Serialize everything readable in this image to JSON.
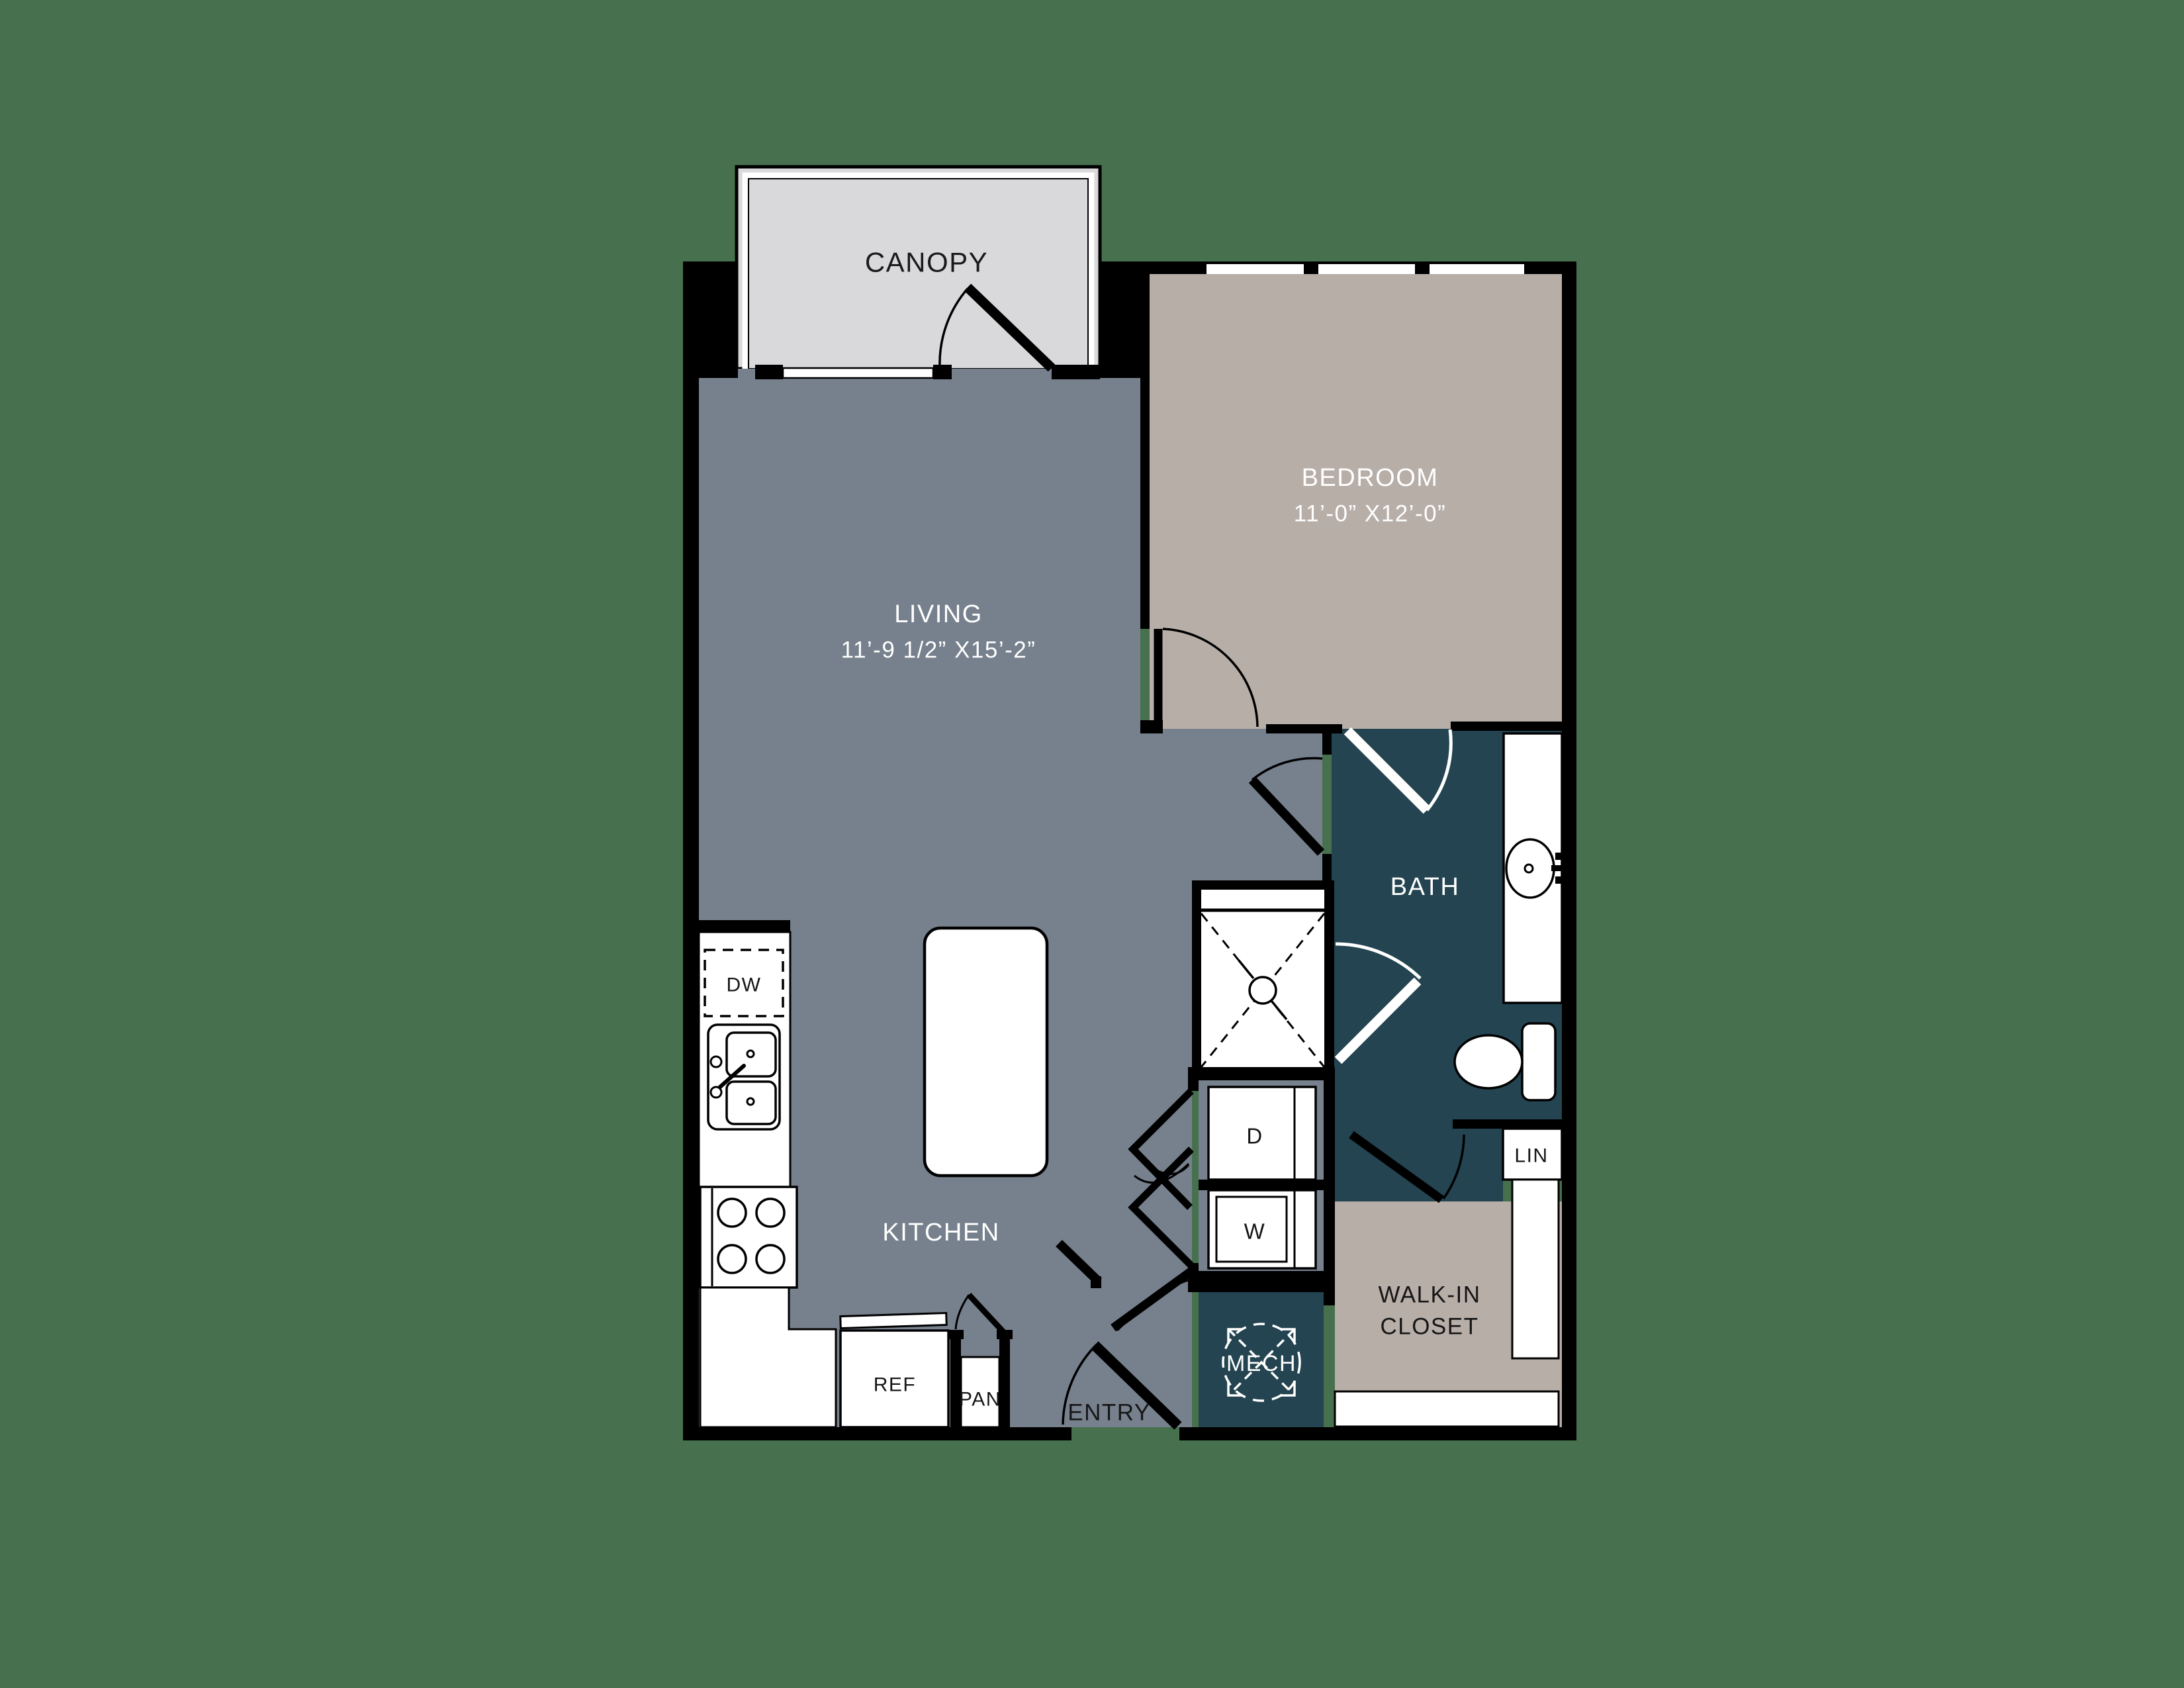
{
  "floorplan": {
    "background_color": "#47714E",
    "colors": {
      "floor_gray": "#77818D",
      "floor_tan": "#B7AEA8",
      "floor_teal": "#234450",
      "canopy_gray": "#D9D9DB",
      "wall_black": "#000000",
      "fixture_white": "#FFFFFF"
    },
    "rooms": {
      "canopy": {
        "label": "CANOPY"
      },
      "living": {
        "label": "LIVING",
        "dims": "11’-9 1/2” X15’-2”"
      },
      "bedroom": {
        "label": "BEDROOM",
        "dims": "11’-0” X12’-0”"
      },
      "bath": {
        "label": "BATH"
      },
      "kitchen": {
        "label": "KITCHEN"
      },
      "walk_in_closet": {
        "label_line1": "WALK-IN",
        "label_line2": "CLOSET"
      },
      "entry": {
        "label": "ENTRY"
      },
      "mech": {
        "label": "MECH"
      }
    },
    "fixtures": {
      "dishwasher": "DW",
      "refrigerator": "REF",
      "pantry": "PAN",
      "dryer": "D",
      "washer": "W",
      "linen": "LIN"
    }
  }
}
